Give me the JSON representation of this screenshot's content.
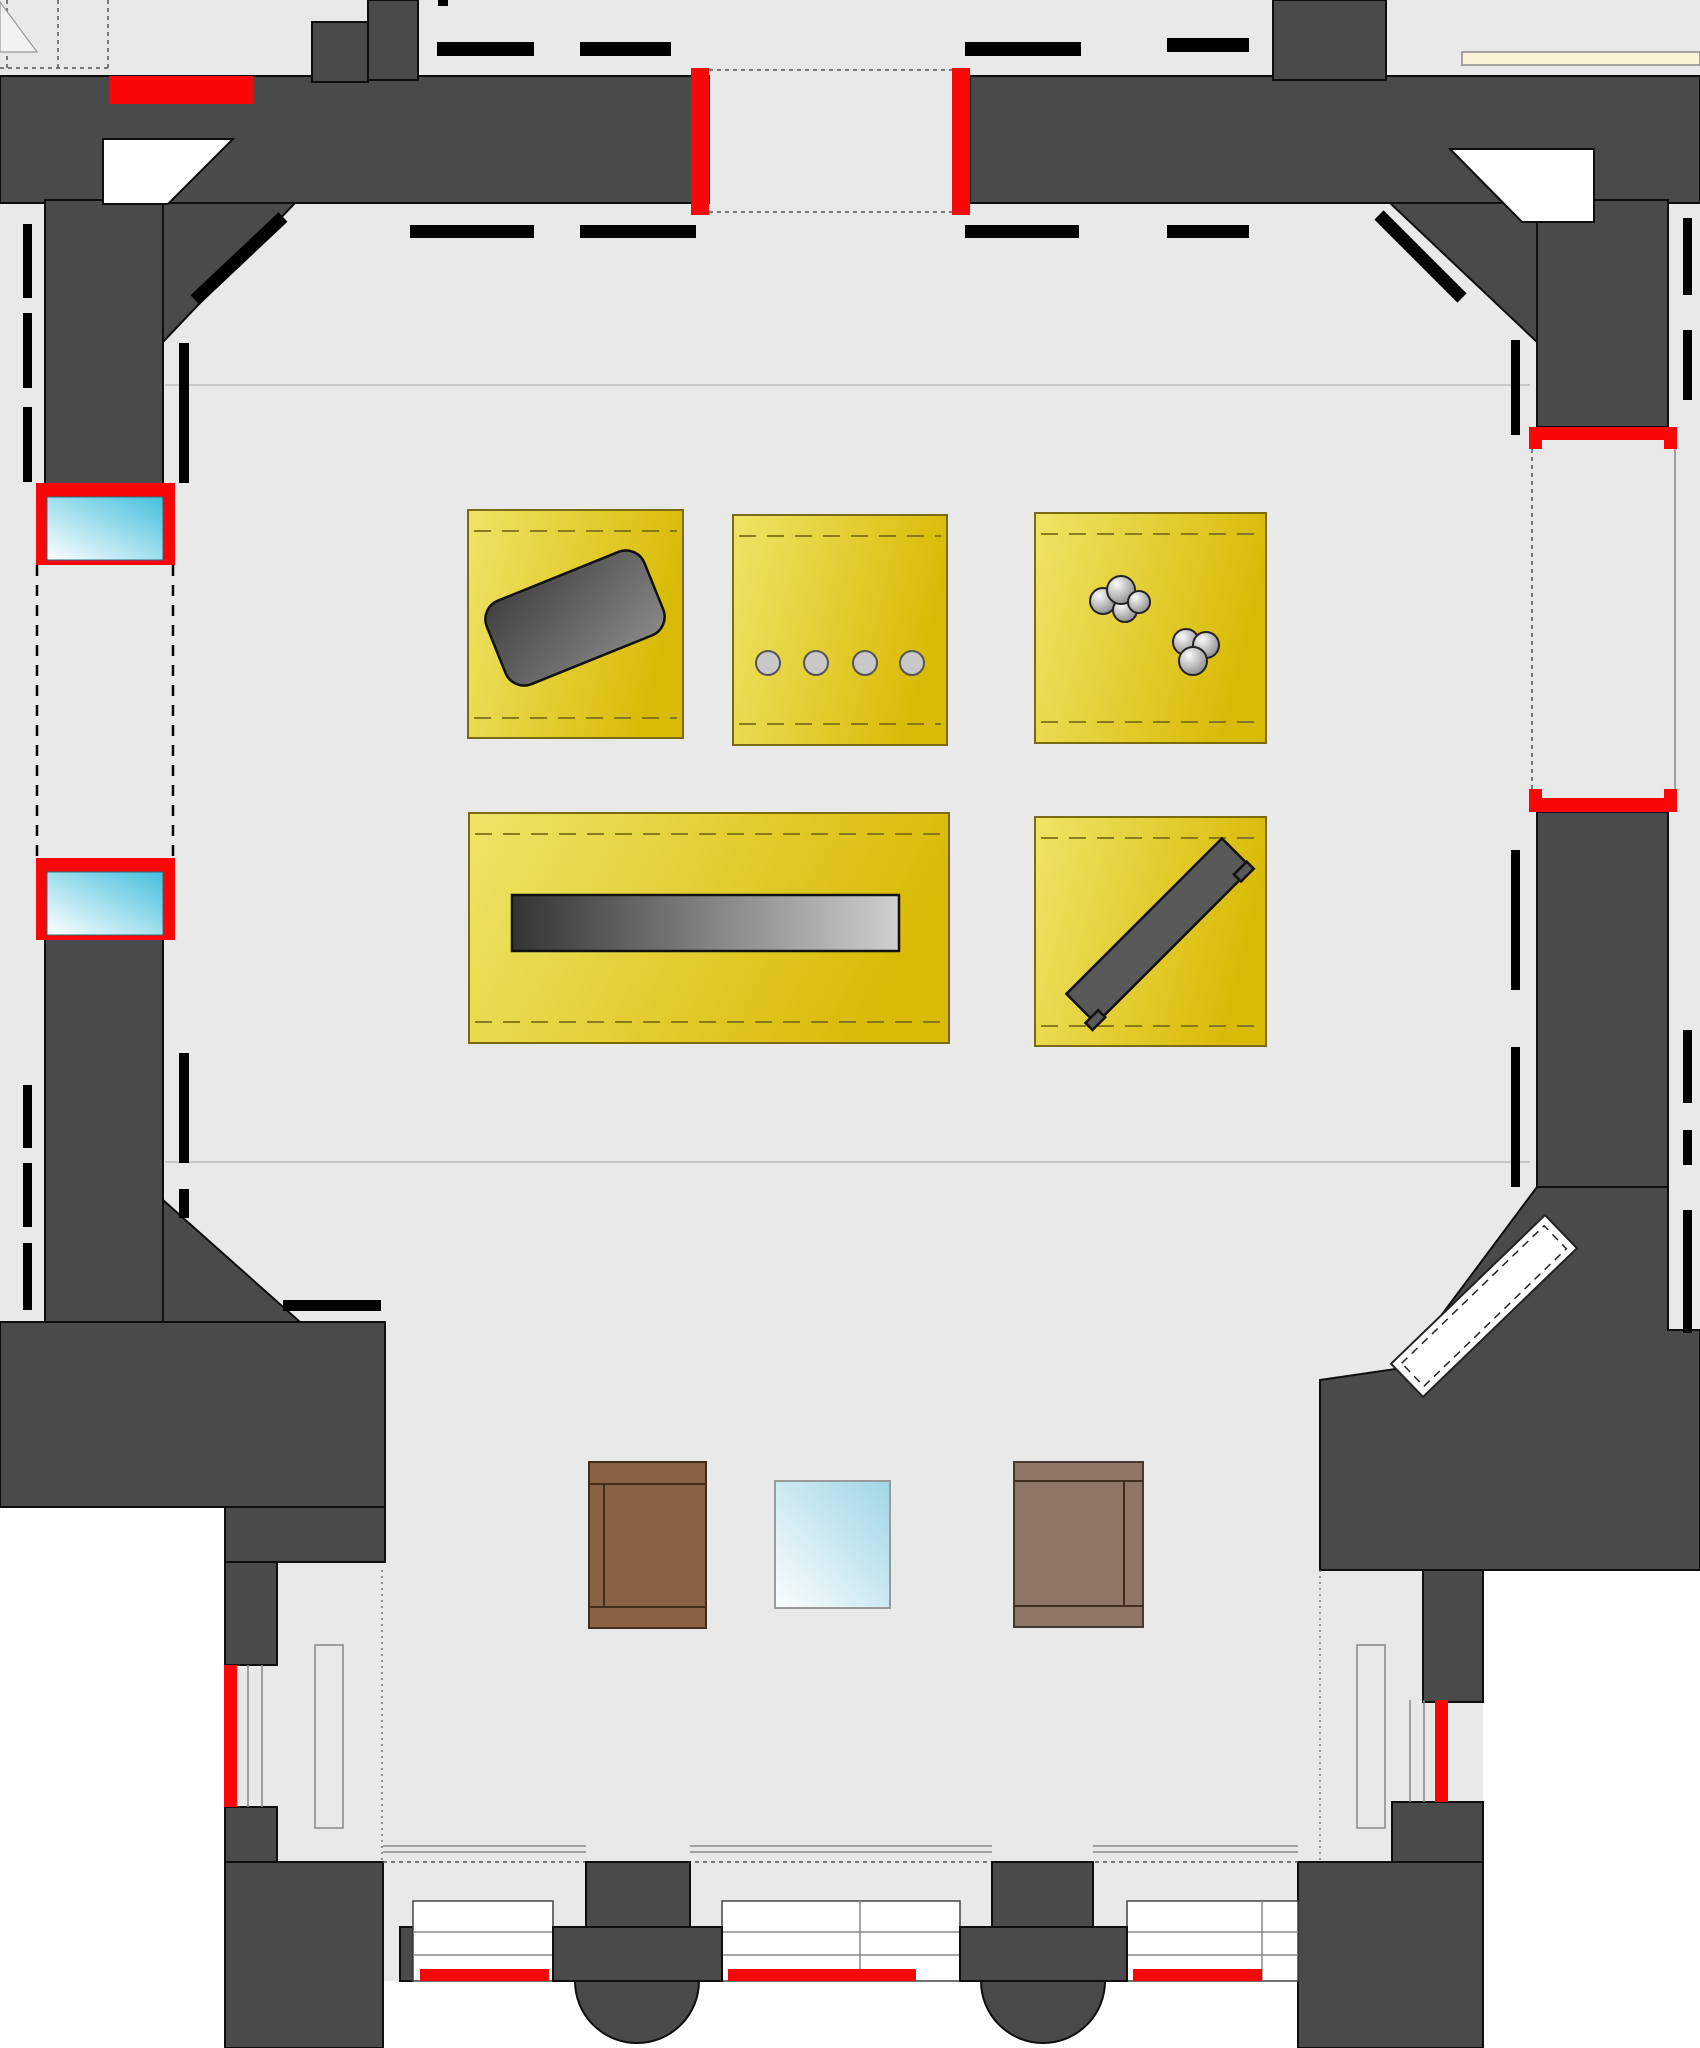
{
  "document": {
    "type": "architectural-floor-plan",
    "subject": "gallery level plan with exhibition cases, window bays and entrance portico",
    "visible_text": []
  },
  "colors": {
    "background": "#e9e9e9",
    "outside": "#ffffff",
    "wall": "#4a4a4a",
    "wall_outline": "#0e0e0e",
    "black": "#000000",
    "highlight_red": "#f90606",
    "case_border": "#7a6a10",
    "case_dash": "#7d6e14",
    "line_gray": "#888888",
    "faint_gray": "#b3b3b3",
    "wood_dark": "#8a6242",
    "wood_light": "#8d7665",
    "beige": "#fbf3d5",
    "glass_cyan": "#45bfdc",
    "artifact_gray": "#585858"
  },
  "inventory": {
    "display_cases": [
      {
        "id": "case-1",
        "position": "upper-left",
        "contents": "rotated rectangular slab",
        "object_count": 1
      },
      {
        "id": "case-2",
        "position": "upper-middle",
        "contents": "row of four discs",
        "object_count": 4
      },
      {
        "id": "case-3",
        "position": "upper-right",
        "contents": "two clusters of spheres",
        "object_count": 7
      },
      {
        "id": "case-4",
        "position": "lower-wide",
        "contents": "long horizontal beam",
        "object_count": 1
      },
      {
        "id": "case-5",
        "position": "lower-right",
        "contents": "diagonal bench",
        "object_count": 1
      }
    ],
    "windows": {
      "left_wall_glazed": 2,
      "right_wall_bay": 1,
      "portico_bays": 3
    },
    "furniture": {
      "wood_cabinets": 2,
      "central_glass_panel": 1
    },
    "red_opening_highlights": 10,
    "round_columns": 2,
    "wall_niches": 2,
    "corner_ramp": 1
  }
}
